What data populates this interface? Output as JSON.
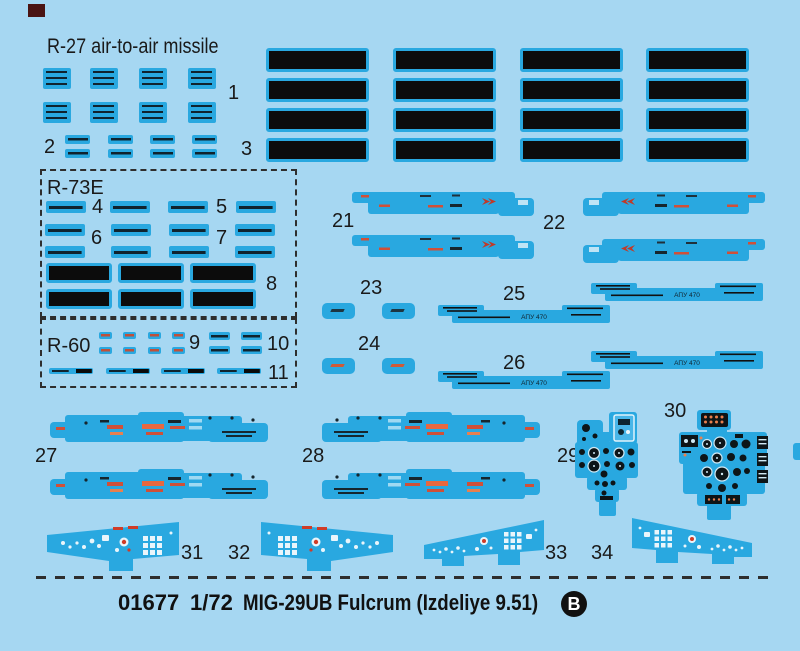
{
  "sheet": {
    "sections": {
      "r27_title": "R-27 air-to-air missile",
      "r73e_title": "R-73E",
      "r60_title": "R-60"
    },
    "callouts": {
      "c1": "1",
      "c2": "2",
      "c3": "3",
      "c4": "4",
      "c5": "5",
      "c6": "6",
      "c7": "7",
      "c8": "8",
      "c9": "9",
      "c10": "10",
      "c11": "11",
      "c21": "21",
      "c22": "22",
      "c23": "23",
      "c24": "24",
      "c25": "25",
      "c26": "26",
      "c27": "27",
      "c28": "28",
      "c29": "29",
      "c30": "30",
      "c31": "31",
      "c32": "32",
      "c33": "33",
      "c34": "34"
    },
    "decal_text": {
      "apu_rail": "АПУ 470"
    },
    "footer": {
      "kit_number": "01677",
      "scale": "1/72",
      "kit_name": "MIG-29UB Fulcrum (Izdeliye 9.51)",
      "sheet_letter": "B"
    },
    "colors": {
      "background": "#a6d7f2",
      "decal_blue": "#29a8e0",
      "strip_black": "#0c0c0c",
      "accent_red": "#d03c28",
      "accent_orange": "#e8744f",
      "registration_mark": "#4a1413",
      "text": "#1a1a1a"
    }
  }
}
